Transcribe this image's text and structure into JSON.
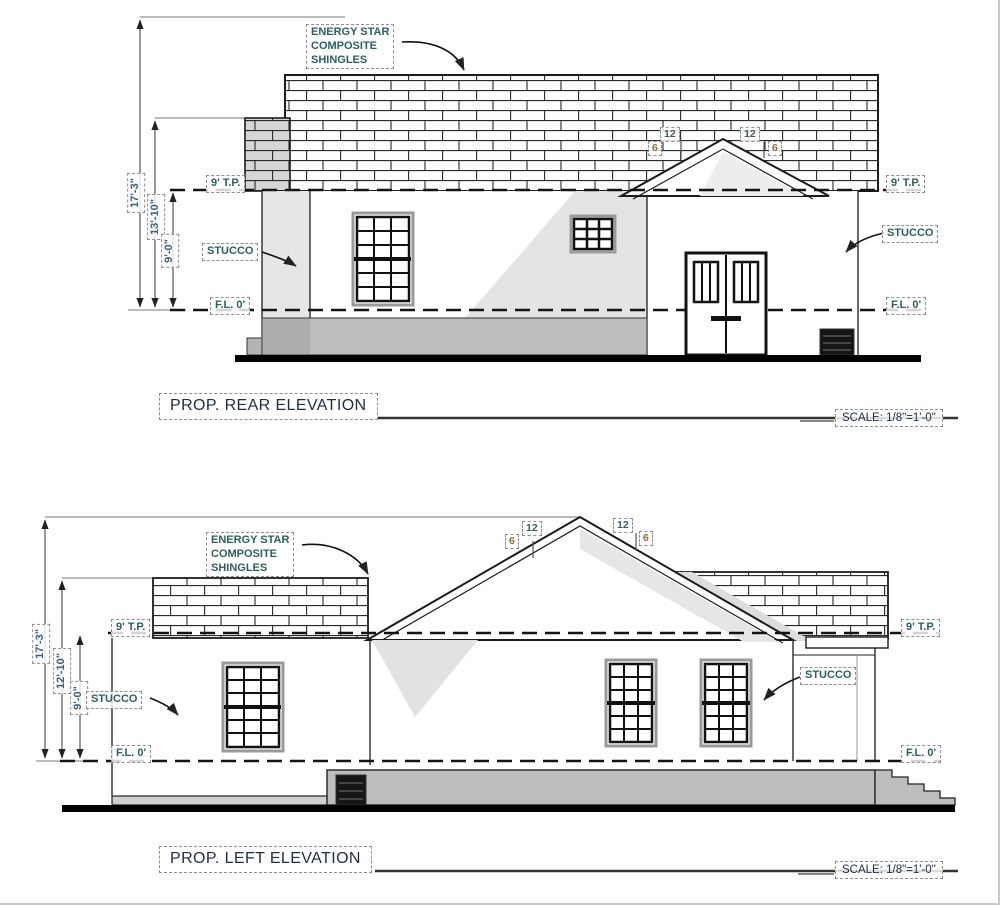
{
  "rear": {
    "title": "PROP. REAR ELEVATION",
    "scale_label": "SCALE: 1/8\"=1'-0\"",
    "shingles_note": [
      "ENERGY STAR",
      "COMPOSITE",
      "SHINGLES"
    ],
    "dim_total": "17'-3\"",
    "dim_ridge": "13'-10\"",
    "dim_wall": "9'-0\"",
    "top_plate": "9' T.P.",
    "floor": "F.L. 0'",
    "stucco": "STUCCO",
    "slope_rise": "12",
    "slope_run": "6"
  },
  "left": {
    "title": "PROP. LEFT ELEVATION",
    "scale_label": "SCALE: 1/8\"=1'-0\"",
    "shingles_note": [
      "ENERGY STAR",
      "COMPOSITE",
      "SHINGLES"
    ],
    "dim_total": "17'-3\"",
    "dim_ridge": "12'-10\"",
    "dim_wall": "9'-0\"",
    "top_plate": "9' T.P.",
    "floor": "F.L. 0'",
    "stucco": "STUCCO",
    "slope_rise": "12",
    "slope_run": "6"
  },
  "colors": {
    "label_text": "#2d5f5f",
    "dim_text": "#3a6080",
    "title_text": "#1f2c47",
    "line": "#1c1c1c",
    "foundation": "#bdbdbd",
    "shade": "#e4e4e4"
  }
}
